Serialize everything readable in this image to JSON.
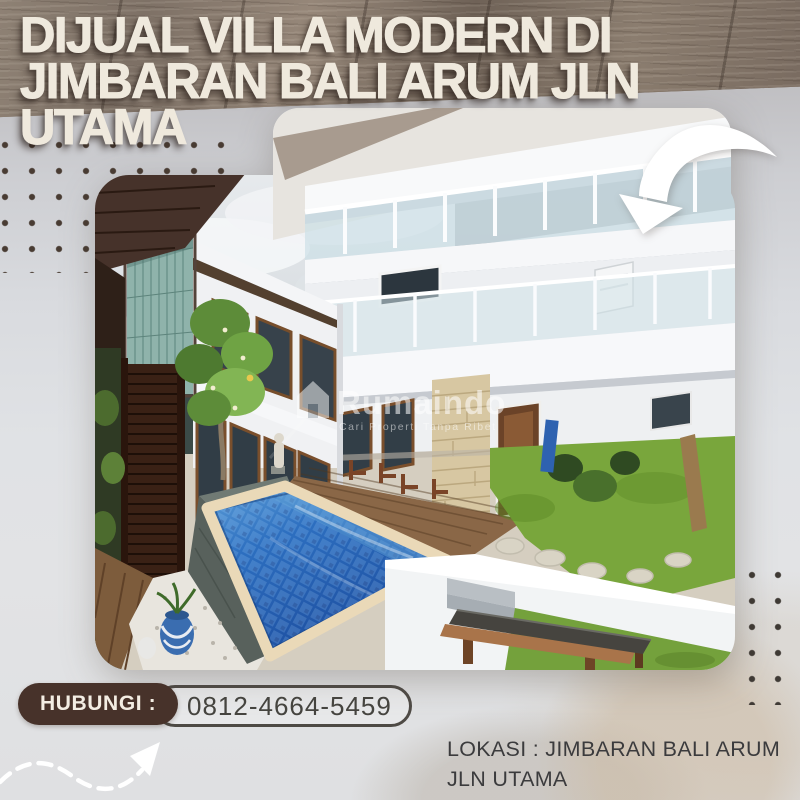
{
  "title": {
    "line1": "DIJUAL VILLA MODERN DI",
    "line2": "JIMBARAN BALI ARUM JLN",
    "line3": "UTAMA"
  },
  "contact": {
    "label": "HUBUNGI :",
    "phone": "0812-4664-5459"
  },
  "location": {
    "line1": "LOKASI : JIMBARAN BALI ARUM",
    "line2": "JLN UTAMA"
  },
  "watermark": {
    "brand": "Rumaindo",
    "tagline": "Cari Properti Tanpa Ribet"
  },
  "icons": {
    "big_arrow": "curved-arrow-pointing-down-left",
    "dashed_arrow": "dashed-arrow-pointing-up-right",
    "watermark_house": "house-icon"
  },
  "colors": {
    "wood_band": "#83756a",
    "background_top": "#b6b4b6",
    "background_bottom": "#dfe0e2",
    "title_text": "#efe9dd",
    "title_shadow": "#2e241d",
    "badge_brown": "#47322a",
    "badge_text": "#f3ede3",
    "phone_text": "#45443f",
    "phone_border": "#4e4a45",
    "location_text": "#3b3b3d",
    "dots": "#493c33",
    "pool_blue": "#2d6fc0",
    "lawn_green": "#74a63c"
  }
}
